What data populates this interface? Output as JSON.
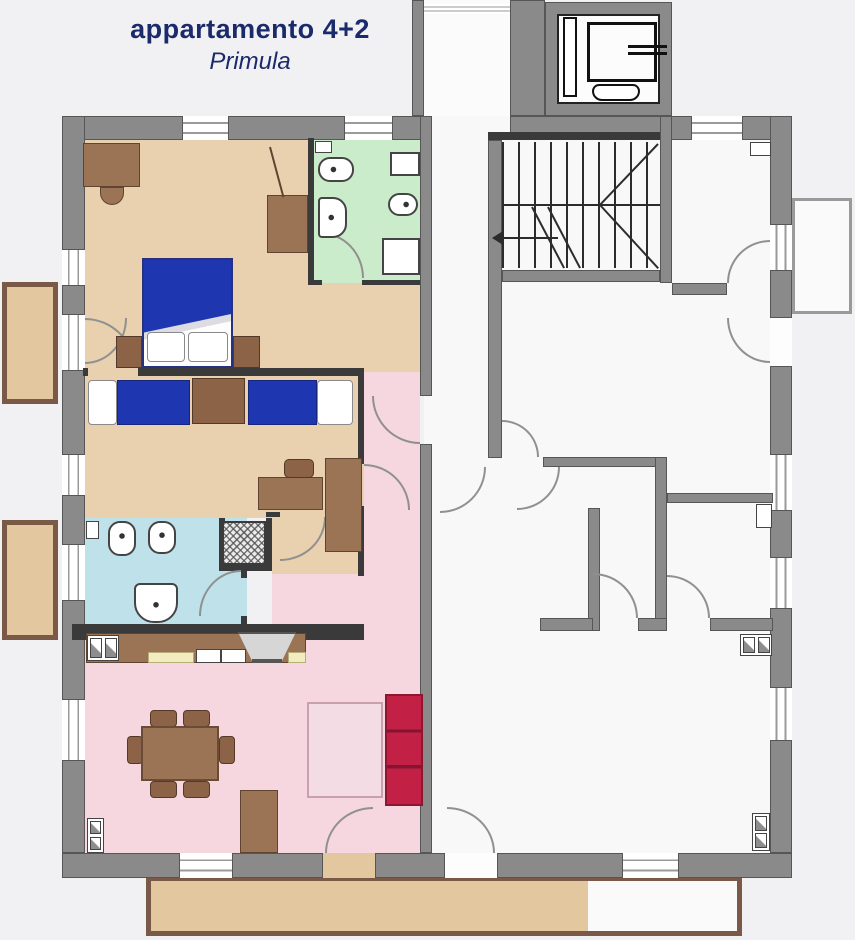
{
  "title": {
    "line1": "appartamento 4+2",
    "line2": "Primula"
  },
  "palette": {
    "background": "#f1f1f3",
    "wall_gray": "#8a8a8a",
    "partition_dark": "#3a3a3a",
    "title_navy": "#1b2a6b",
    "bedroom_tan": "#e9d0ae",
    "balcony_tan": "#e2c79f",
    "bathroom_green": "#cbeccb",
    "bathroom_blue": "#bfe2ea",
    "living_pink": "#f6d7e0",
    "bed_blue": "#1e36b0",
    "sofa_red": "#c22045",
    "furniture_brown": "#9b7355",
    "counter_cream": "#f3ecc0",
    "neighbor_floor": "#f8f8f9"
  },
  "rooms": [
    {
      "label": "bedroom-1-double",
      "color": "#e9d0ae"
    },
    {
      "label": "bathroom-green",
      "color": "#cbeccb"
    },
    {
      "label": "bedroom-2-twin",
      "color": "#e9d0ae"
    },
    {
      "label": "bathroom-blue",
      "color": "#bfe2ea"
    },
    {
      "label": "living-room-kitchen",
      "color": "#f6d7e0"
    },
    {
      "label": "hallway",
      "color": "#f6d7e0"
    },
    {
      "label": "stairwell",
      "color": "#f8f8f9"
    },
    {
      "label": "elevator",
      "color": "#fcfcfc"
    },
    {
      "label": "neighboring-apartment",
      "color": "#f8f8f9"
    },
    {
      "label": "balconies",
      "color": "#e2c79f"
    }
  ],
  "fixtures": [
    "double-bed",
    "twin-bed",
    "nightstand",
    "wardrobe",
    "desk",
    "chair",
    "toilet",
    "bidet",
    "sink",
    "shower",
    "washer",
    "kitchen-counter",
    "kitchen-sink",
    "cooker-hood",
    "fridge",
    "dining-table",
    "sofa",
    "tv-stand",
    "rug",
    "radiator",
    "boiler",
    "elevator-car",
    "stairs"
  ]
}
